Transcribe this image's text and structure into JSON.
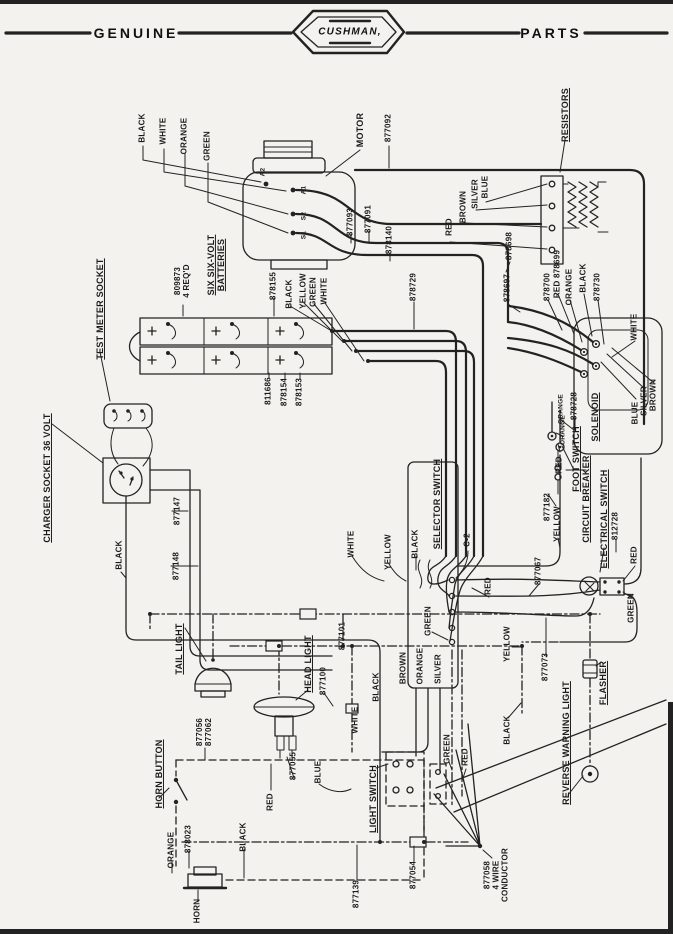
{
  "header": {
    "left": "GENUINE",
    "brand": "CUSHMAN,",
    "right": "PARTS"
  },
  "diagram": {
    "labels": [
      {
        "id": "color-black-motor",
        "text": "BLACK",
        "x": 143,
        "y": 128
      },
      {
        "id": "color-white-motor",
        "text": "WHITE",
        "x": 164,
        "y": 131
      },
      {
        "id": "color-orange-motor",
        "text": "ORANGE",
        "x": 185,
        "y": 136
      },
      {
        "id": "color-green-motor",
        "text": "GREEN",
        "x": 208,
        "y": 146
      },
      {
        "id": "motor",
        "text": "MOTOR",
        "x": 360,
        "y": 130,
        "fs": 9
      },
      {
        "id": "pn-877092",
        "text": "877092",
        "x": 389,
        "y": 128
      },
      {
        "id": "pn-877093",
        "text": "877093",
        "x": 351,
        "y": 222
      },
      {
        "id": "pn-877091",
        "text": "877091",
        "x": 369,
        "y": 219
      },
      {
        "id": "pn-878140",
        "text": "878140",
        "x": 390,
        "y": 240
      },
      {
        "id": "term-a2",
        "text": "A2",
        "x": 263,
        "y": 172,
        "fs": 6.5
      },
      {
        "id": "term-a1",
        "text": "A1",
        "x": 304,
        "y": 190,
        "fs": 6.5
      },
      {
        "id": "term-s2",
        "text": "S2",
        "x": 304,
        "y": 216,
        "fs": 6.5
      },
      {
        "id": "term-s1",
        "text": "S1",
        "x": 304,
        "y": 235,
        "fs": 6.5
      },
      {
        "id": "resistors",
        "text": "RESISTORS",
        "x": 565,
        "y": 115,
        "fs": 9,
        "ul": true
      },
      {
        "id": "color-red-resistor",
        "text": "RED",
        "x": 450,
        "y": 227
      },
      {
        "id": "color-brown-resistor",
        "text": "BROWN",
        "x": 464,
        "y": 207
      },
      {
        "id": "color-silver-resistor",
        "text": "SILVER",
        "x": 476,
        "y": 194
      },
      {
        "id": "color-blue-resistor",
        "text": "BLUE",
        "x": 486,
        "y": 187
      },
      {
        "id": "pn-878698",
        "text": "878698",
        "x": 510,
        "y": 246
      },
      {
        "id": "pn-878697",
        "text": "878697",
        "x": 508,
        "y": 288
      },
      {
        "id": "pn-878700",
        "text": "878700",
        "x": 548,
        "y": 287
      },
      {
        "id": "pn-878699",
        "text": "RED 878699",
        "x": 558,
        "y": 274
      },
      {
        "id": "color-orange-solenoid-top",
        "text": "ORANGE",
        "x": 570,
        "y": 287
      },
      {
        "id": "color-black-solenoid-top",
        "text": "BLACK",
        "x": 584,
        "y": 278
      },
      {
        "id": "pn-878730",
        "text": "878730",
        "x": 598,
        "y": 287
      },
      {
        "id": "color-white-right",
        "text": "WHITE",
        "x": 635,
        "y": 327
      },
      {
        "id": "color-blue-solenoid",
        "text": "BLUE",
        "x": 636,
        "y": 413
      },
      {
        "id": "color-silver-solenoid",
        "text": "SILVER",
        "x": 645,
        "y": 401
      },
      {
        "id": "color-brown-solenoid",
        "text": "BROWN",
        "x": 654,
        "y": 395
      },
      {
        "id": "color-orange-878728",
        "text": "ORANGE",
        "x": 561,
        "y": 409,
        "fs": 6.5
      },
      {
        "id": "pn-878728",
        "text": "878728",
        "x": 575,
        "y": 406
      },
      {
        "id": "solenoid",
        "text": "SOLENOID",
        "x": 595,
        "y": 417,
        "fs": 9,
        "ul": true
      },
      {
        "id": "pn-809873",
        "text": "809873\n4 REQ'D",
        "x": 183,
        "y": 281
      },
      {
        "id": "batteries",
        "text": "SIX SIX-VOLT\nBATTERIES",
        "x": 216,
        "y": 265,
        "fs": 9,
        "ul": true
      },
      {
        "id": "pn-878155",
        "text": "878155",
        "x": 274,
        "y": 286
      },
      {
        "id": "color-black-battery",
        "text": "BLACK",
        "x": 290,
        "y": 294
      },
      {
        "id": "color-yellow-battery",
        "text": "YELLOW",
        "x": 304,
        "y": 291
      },
      {
        "id": "color-green-battery",
        "text": "GREEN",
        "x": 314,
        "y": 292
      },
      {
        "id": "color-white-battery",
        "text": "WHITE",
        "x": 325,
        "y": 291
      },
      {
        "id": "pn-811686",
        "text": "811686",
        "x": 269,
        "y": 391
      },
      {
        "id": "pn-878154",
        "text": "878154",
        "x": 285,
        "y": 392
      },
      {
        "id": "pn-878153",
        "text": "878153",
        "x": 300,
        "y": 392
      },
      {
        "id": "test-meter-socket",
        "text": "TEST METER SOCKET",
        "x": 100,
        "y": 309,
        "fs": 9,
        "ul": true
      },
      {
        "id": "charger-socket",
        "text": "CHARGER SOCKET 36 VOLT",
        "x": 47,
        "y": 478,
        "fs": 9,
        "ul": true
      },
      {
        "id": "pn-877147",
        "text": "877147",
        "x": 178,
        "y": 511
      },
      {
        "id": "color-black-charger",
        "text": "BLACK",
        "x": 120,
        "y": 555
      },
      {
        "id": "pn-877148",
        "text": "877148",
        "x": 177,
        "y": 566
      },
      {
        "id": "pn-878729",
        "text": "878729",
        "x": 414,
        "y": 287
      },
      {
        "id": "selector-switch",
        "text": "SELECTOR SWITCH",
        "x": 437,
        "y": 504,
        "fs": 9,
        "ul": true
      },
      {
        "id": "c2",
        "text": "C-2",
        "x": 468,
        "y": 540
      },
      {
        "id": "color-white-selector",
        "text": "WHITE",
        "x": 352,
        "y": 544
      },
      {
        "id": "color-yellow-selector",
        "text": "YELLOW",
        "x": 389,
        "y": 552
      },
      {
        "id": "color-black-selector",
        "text": "BLACK",
        "x": 416,
        "y": 544
      },
      {
        "id": "color-red-selector",
        "text": "RED",
        "x": 489,
        "y": 586
      },
      {
        "id": "color-green-selector",
        "text": "GREEN",
        "x": 429,
        "y": 621
      },
      {
        "id": "color-brown-selector",
        "text": "BROWN",
        "x": 404,
        "y": 668
      },
      {
        "id": "color-orange-selector",
        "text": "ORANGE",
        "x": 421,
        "y": 666
      },
      {
        "id": "color-silver-selector",
        "text": "SILVER",
        "x": 439,
        "y": 669
      },
      {
        "id": "color-yellow-right",
        "text": "YELLOW",
        "x": 508,
        "y": 644
      },
      {
        "id": "color-black-center",
        "text": "BLACK",
        "x": 377,
        "y": 687
      },
      {
        "id": "pn-877067",
        "text": "877067",
        "x": 539,
        "y": 571
      },
      {
        "id": "foot-switch",
        "text": "FOOT SWITCH",
        "x": 576,
        "y": 459,
        "fs": 9,
        "ul": true
      },
      {
        "id": "color-orange-foot",
        "text": "ORANGE",
        "x": 563,
        "y": 430,
        "fs": 6.5
      },
      {
        "id": "color-red-foot",
        "text": "RED",
        "x": 560,
        "y": 465
      },
      {
        "id": "pn-877182",
        "text": "877182",
        "x": 548,
        "y": 507
      },
      {
        "id": "color-yellow-foot",
        "text": "YELLOW",
        "x": 558,
        "y": 524
      },
      {
        "id": "circuit-breaker",
        "text": "CIRCUIT BREAKER",
        "x": 586,
        "y": 499,
        "fs": 9,
        "ul": true
      },
      {
        "id": "electrical-switch",
        "text": "ELECTRICAL SWITCH",
        "x": 604,
        "y": 519,
        "fs": 9,
        "ul": true
      },
      {
        "id": "pn-812728",
        "text": "812728",
        "x": 616,
        "y": 526
      },
      {
        "id": "color-red-key",
        "text": "RED",
        "x": 635,
        "y": 555
      },
      {
        "id": "color-green-key",
        "text": "GREEN",
        "x": 632,
        "y": 608
      },
      {
        "id": "tail-light",
        "text": "TAIL LIGHT",
        "x": 179,
        "y": 649,
        "fs": 9,
        "ul": true
      },
      {
        "id": "head-light",
        "text": "HEAD LIGHT",
        "x": 308,
        "y": 664,
        "fs": 9,
        "ul": true
      },
      {
        "id": "pn-877100",
        "text": "877100",
        "x": 324,
        "y": 681
      },
      {
        "id": "pn-877101",
        "text": "877101",
        "x": 343,
        "y": 636
      },
      {
        "id": "color-white-head",
        "text": "WHITE",
        "x": 356,
        "y": 720
      },
      {
        "id": "pn-877073",
        "text": "877073",
        "x": 546,
        "y": 667
      },
      {
        "id": "color-black-bottom",
        "text": "BLACK",
        "x": 508,
        "y": 730
      },
      {
        "id": "color-green-bottom",
        "text": "GREEN",
        "x": 448,
        "y": 749
      },
      {
        "id": "color-red-bottom",
        "text": "RED",
        "x": 466,
        "y": 757
      },
      {
        "id": "horn-button",
        "text": "HORN BUTTON",
        "x": 159,
        "y": 774,
        "fs": 9,
        "ul": true
      },
      {
        "id": "pn-877056-877062",
        "text": "877056\n877062",
        "x": 205,
        "y": 732
      },
      {
        "id": "pn-877055",
        "text": "877055",
        "x": 294,
        "y": 766
      },
      {
        "id": "color-blue-light",
        "text": "BLUE",
        "x": 319,
        "y": 772
      },
      {
        "id": "light-switch",
        "text": "LIGHT SWITCH",
        "x": 373,
        "y": 799,
        "fs": 9,
        "ul": true
      },
      {
        "id": "color-red-horn",
        "text": "RED",
        "x": 271,
        "y": 802
      },
      {
        "id": "color-orange-horn",
        "text": "ORANGE",
        "x": 172,
        "y": 850
      },
      {
        "id": "pn-878023",
        "text": "878023",
        "x": 189,
        "y": 839
      },
      {
        "id": "color-black-horn",
        "text": "BLACK",
        "x": 244,
        "y": 837
      },
      {
        "id": "pn-877139",
        "text": "877139",
        "x": 357,
        "y": 894
      },
      {
        "id": "pn-877054",
        "text": "877054",
        "x": 414,
        "y": 875
      },
      {
        "id": "pn-877058",
        "text": "877058\n4 WIRE\nCONDUCTOR",
        "x": 497,
        "y": 875
      },
      {
        "id": "flasher",
        "text": "FLASHER",
        "x": 603,
        "y": 683,
        "fs": 9,
        "ul": true
      },
      {
        "id": "reverse-warning-light",
        "text": "REVERSE WARNING LIGHT",
        "x": 566,
        "y": 743,
        "fs": 9,
        "ul": true
      },
      {
        "id": "horn",
        "text": "HORN",
        "x": 198,
        "y": 911
      }
    ]
  }
}
